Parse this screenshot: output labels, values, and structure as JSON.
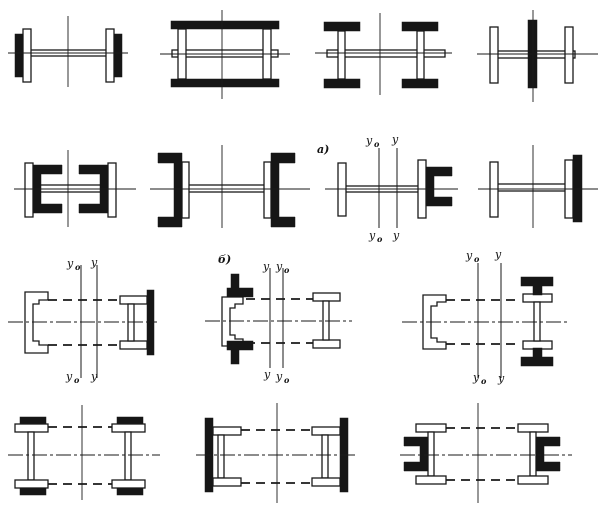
{
  "page": {
    "background": "#ffffff",
    "ink": "#1a1a1a"
  },
  "labels": {
    "panel_a": "а)",
    "panel_b": "б)",
    "axis_y0_main": "у",
    "axis_y0_sub": "о",
    "axis_y_main": "у"
  },
  "sections": [
    {
      "id": "fig-1-1",
      "name": "web-plate-with-edge-plates-and-black-side-plates"
    },
    {
      "id": "fig-1-2",
      "name": "twin-web-box-with-black-cover-plates"
    },
    {
      "id": "fig-1-3",
      "name": "two-i-sections-with-black-flanges-joined-by-web-plate"
    },
    {
      "id": "fig-1-4",
      "name": "cruciform-web-plate-with-central-black-plate"
    },
    {
      "id": "fig-2-1",
      "name": "edge-plates-with-inward-black-channels"
    },
    {
      "id": "fig-2-2",
      "name": "edge-plates-with-outward-black-channels"
    },
    {
      "id": "fig-2-3",
      "name": "asymmetric-plate-and-black-channel-panel-a"
    },
    {
      "id": "fig-2-4",
      "name": "asymmetric-plate-and-black-strip"
    },
    {
      "id": "fig-3-1",
      "name": "laced-channel-and-i-section-with-black-side-plate"
    },
    {
      "id": "fig-3-2",
      "name": "laced-channel-with-black-corner-angles-and-i-section-panel-b"
    },
    {
      "id": "fig-3-3",
      "name": "laced-channel-and-i-section-with-black-tee-stiffeners"
    },
    {
      "id": "fig-4-1",
      "name": "laced-two-i-sections-with-black-flange-plates"
    },
    {
      "id": "fig-4-2",
      "name": "laced-two-i-sections-with-outer-black-side-plates"
    },
    {
      "id": "fig-4-3",
      "name": "laced-two-i-sections-with-outer-black-channels"
    }
  ]
}
